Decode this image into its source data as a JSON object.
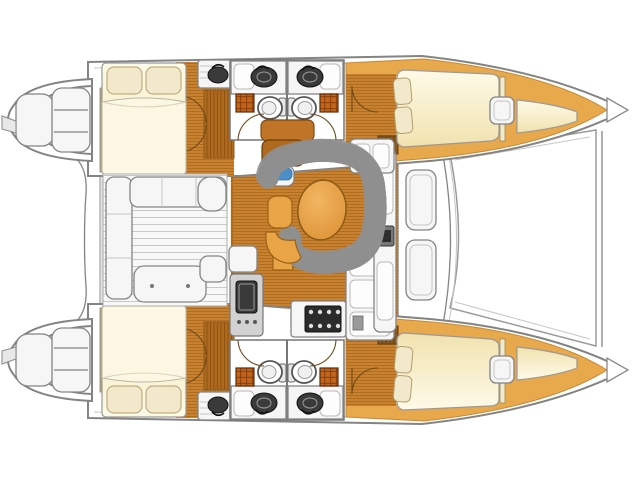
{
  "palette": {
    "canvas": "#ffffff",
    "outline": "#848484",
    "wood": "#c8812f",
    "wood_line": "#9c5c14",
    "wood_dark": "#b06a1e",
    "deck": "#e8a84c",
    "deck_deep": "#c98830",
    "cream_light": "#fdfae8",
    "cream_deep": "#f1e2ae",
    "pillow": "#f2e9cc",
    "pillow_edge": "#b3a06a",
    "blue": "#4d90c8",
    "blue_light": "#a9d0ea",
    "table_orange": "#e9a446",
    "fixture_white": "#f6f6f6",
    "fixture_grey": "#d2d2d2",
    "fixture_dark": "#3a3a3a",
    "hatch_orange": "#c2641c",
    "hatch_grid": "#7e3c0e",
    "tan_wall": "#b5a478"
  },
  "diagram": {
    "type": "catamaran-interior-floorplan",
    "orientation": "bow-right",
    "symmetry": "mirrored-hulls",
    "hull_areas": [
      "swim-platform-with-steps",
      "aft-double-cabin",
      "wardrobe-with-double-doors",
      "twin-heads-with-toilet-sink-shower-tray",
      "forward-double-cabin",
      "forepeak-berth",
      "bow-deck-hatch"
    ],
    "center_areas": [
      "aft-crossbar",
      "cockpit-with-l-bench-and-aft-bench",
      "companionway-steps",
      "galley-sink-module",
      "galley-stove-module",
      "galley-counter-column",
      "dinette-settee",
      "oval-dining-table",
      "forward-sideboard",
      "coachroof-hatches",
      "foredeck-trampoline",
      "forward-crossbeam"
    ],
    "fixture_counts": {
      "toilets": 4,
      "head_sinks": 4,
      "outboard_sinks": 2,
      "galley_sink": 1,
      "double_berths": 4,
      "forepeak_berths": 2,
      "swim_platforms": 2,
      "deck_hatches": 4,
      "settee_tables": 1
    }
  }
}
